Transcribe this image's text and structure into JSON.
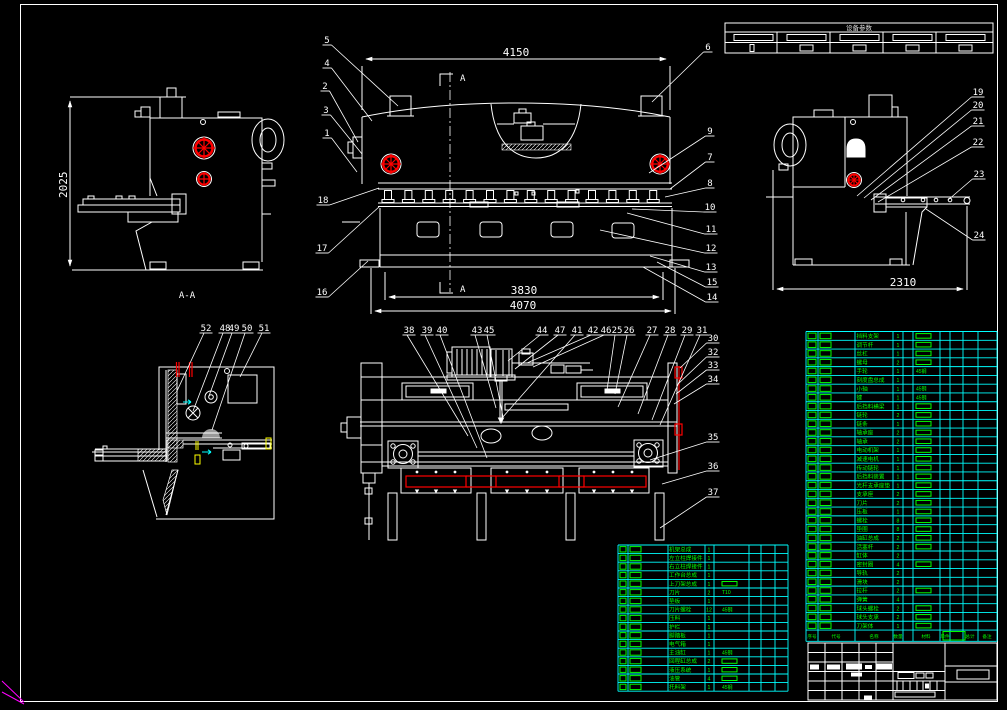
{
  "colors": {
    "background": "#000000",
    "line": "#ffffff",
    "table_grid": "#00ffff",
    "table_text": "#00ff00",
    "accent_red": "#ff0000",
    "accent_yellow": "#ffff00",
    "ucs_magenta": "#ff00ff"
  },
  "views": {
    "side_left": {
      "dim_height": "2025",
      "section_label": "A-A"
    },
    "front": {
      "dim_top": "4150",
      "dim_blade": "3830",
      "dim_base": "4070",
      "cut_mark": "A"
    },
    "side_right": {
      "dim_depth": "2310"
    }
  },
  "callouts": {
    "front_left": [
      "5",
      "4",
      "2",
      "3",
      "1",
      "18",
      "17",
      "16"
    ],
    "front_right": [
      "6",
      "9",
      "7",
      "8",
      "10",
      "11",
      "12",
      "13",
      "15",
      "14"
    ],
    "side_right": [
      "19",
      "20",
      "21",
      "22",
      "23",
      "24"
    ],
    "detail": [
      "52",
      "48",
      "49",
      "50",
      "51"
    ],
    "plan_top": [
      "38",
      "39",
      "40",
      "43",
      "45",
      "44",
      "47",
      "41",
      "42",
      "46",
      "25",
      "26",
      "27",
      "28",
      "29",
      "31"
    ],
    "plan_right": [
      "30",
      "32",
      "33",
      "34",
      "35",
      "36",
      "37"
    ]
  },
  "spec_table": {
    "title": "设备参数"
  },
  "bom_header": [
    "序号",
    "代号",
    "名称",
    "数量",
    "材料",
    "单件",
    "总计",
    "备注"
  ],
  "bom_right": {
    "rows": [
      [
        "挡料支架",
        "1",
        "□"
      ],
      [
        "调节杆",
        "1",
        "□"
      ],
      [
        "丝杠",
        "1",
        "□"
      ],
      [
        "螺母",
        "2",
        "□"
      ],
      [
        "手轮",
        "1",
        "45钢"
      ],
      [
        "刻度盘总成",
        "1",
        ""
      ],
      [
        "小轴",
        "1",
        "45钢"
      ],
      [
        "键",
        "1",
        "45钢"
      ],
      [
        "后挡料横梁",
        "1",
        "□"
      ],
      [
        "链轮",
        "2",
        "□"
      ],
      [
        "链条",
        "1",
        "□"
      ],
      [
        "轴承座",
        "2",
        "□"
      ],
      [
        "轴承",
        "2",
        "□"
      ],
      [
        "电动机架",
        "1",
        "□"
      ],
      [
        "减速电机",
        "1",
        "□"
      ],
      [
        "传动链轮",
        "1",
        "□"
      ],
      [
        "后挡料装置",
        "1",
        "□"
      ],
      [
        "光杆支承座垫",
        "1",
        "□"
      ],
      [
        "支承座",
        "2",
        "□"
      ],
      [
        "刀片",
        "2",
        "□"
      ],
      [
        "压板",
        "1",
        "□"
      ],
      [
        "螺栓",
        "8",
        "□"
      ],
      [
        "垫圈",
        "8",
        "□"
      ],
      [
        "油缸总成",
        "2",
        "□"
      ],
      [
        "活塞杆",
        "2",
        "□"
      ],
      [
        "缸体",
        "2",
        ""
      ],
      [
        "密封圈",
        "4",
        "□"
      ],
      [
        "导轨",
        "2",
        ""
      ],
      [
        "滑块",
        "2",
        ""
      ],
      [
        "拉杆",
        "2",
        "□"
      ],
      [
        "弹簧",
        "4",
        ""
      ],
      [
        "球头螺栓",
        "2",
        "□"
      ],
      [
        "球头支承",
        "2",
        "□"
      ],
      [
        "刀架体",
        "1",
        "□"
      ]
    ]
  },
  "bom_left": {
    "rows": [
      [
        "机架总成",
        "1",
        ""
      ],
      [
        "左立柱焊接件",
        "1",
        ""
      ],
      [
        "右立柱焊接件",
        "1",
        ""
      ],
      [
        "工作台总成",
        "1",
        ""
      ],
      [
        "上刀架总成",
        "1",
        "□"
      ],
      [
        "刀片",
        "2",
        "T10"
      ],
      [
        "垫板",
        "1",
        ""
      ],
      [
        "刀片螺栓",
        "12",
        "45钢"
      ],
      [
        "压料",
        "1",
        ""
      ],
      [
        "护栏",
        "1",
        ""
      ],
      [
        "脚踏板",
        "1",
        ""
      ],
      [
        "电气箱",
        "1",
        ""
      ],
      [
        "主油缸",
        "1",
        "45钢"
      ],
      [
        "回程缸总成",
        "2",
        "□"
      ],
      [
        "液压系统",
        "1",
        "□"
      ],
      [
        "油管",
        "4",
        "□"
      ],
      [
        "托料架",
        "1",
        "45钢"
      ]
    ]
  }
}
